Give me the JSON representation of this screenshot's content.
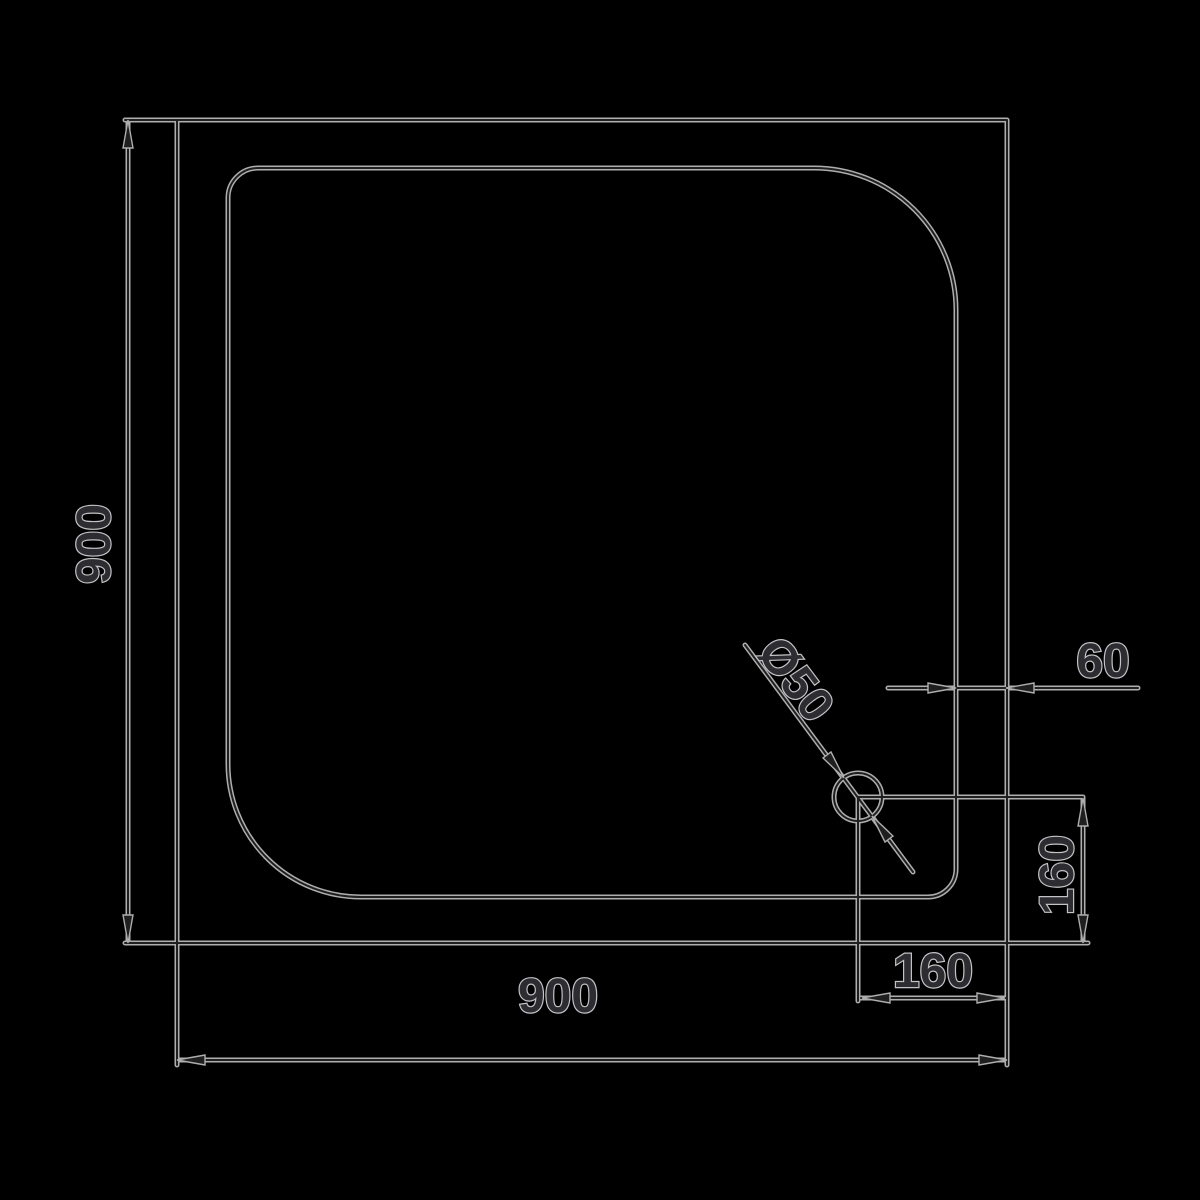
{
  "drawing": {
    "colors": {
      "background": "#000000",
      "line_halo": "#aeaeae",
      "line_core": "#1f1f1f",
      "text_outline": "#c3c3c7",
      "text_fill": "#2d2d31"
    },
    "labels": {
      "overall_width": "900",
      "overall_depth": "900",
      "drain_diameter": "Ø50",
      "rim_offset": "60",
      "drain_offset_bottom": "160",
      "drain_offset_right": "160"
    }
  }
}
